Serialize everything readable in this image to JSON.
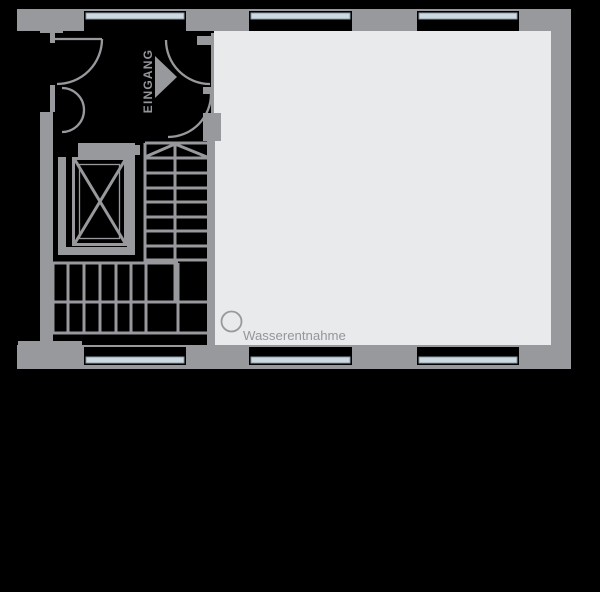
{
  "plan": {
    "labels": {
      "entrance": "EINGANG",
      "water_point": "Wasserentnahme"
    },
    "colors": {
      "wall": "#97999d",
      "room": "#e9eaec",
      "glass": "#ccd9e1",
      "glass_border": "#8b9da8",
      "label": "#94969b",
      "background": "#000000"
    }
  }
}
